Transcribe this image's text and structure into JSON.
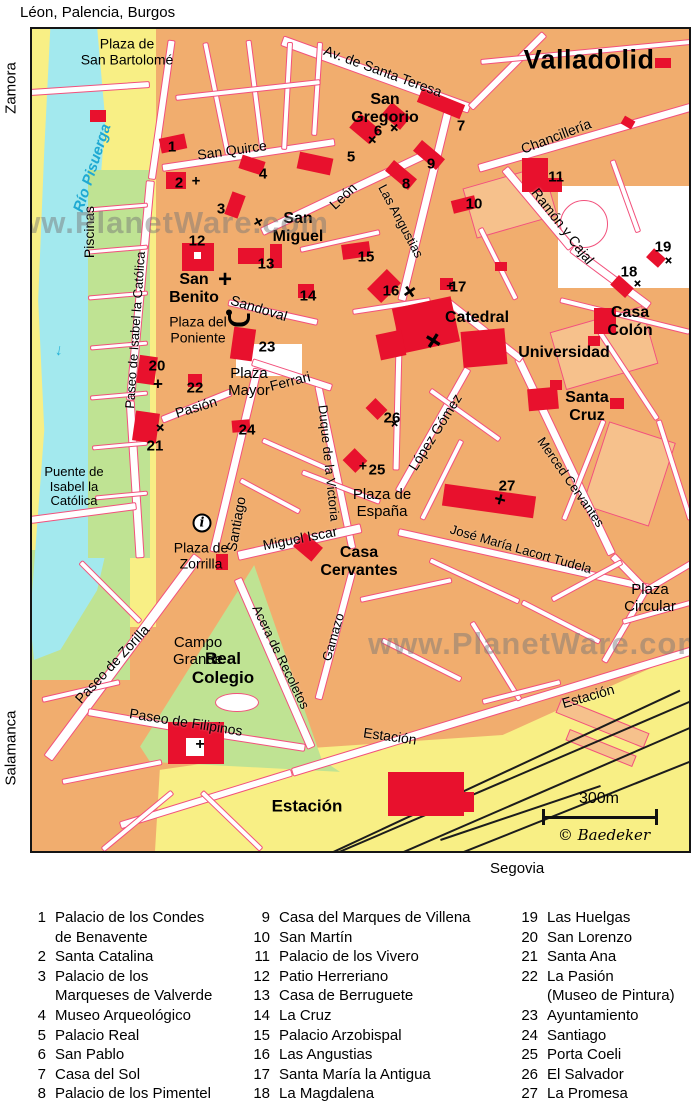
{
  "title": "Valladolid",
  "edges": {
    "top": "Léon, Palencia, Burgos",
    "left_top": "Zamora",
    "left_bottom": "Salamanca",
    "bottom": "Segovia"
  },
  "watermark": {
    "text": "www.PlanetWare.com"
  },
  "scale": {
    "label": "300m",
    "copyright": "© Baedeker"
  },
  "river": {
    "label": "Río Pisuerga",
    "arrow": "↓"
  },
  "info_icon_glyph": "i",
  "colors": {
    "block": "#f1ad6e",
    "block_light": "#f6c18c",
    "road_casing": "#f2517c",
    "building_red": "#e8112d",
    "yellow": "#f8ef85",
    "green": "#bfe393",
    "river_blue": "#a3e9ee",
    "rail_black": "#1c1c1c"
  },
  "street_labels": [
    {
      "text": "Av. de Santa Teresa",
      "x": 383,
      "y": 71,
      "rot": 20,
      "size": 14
    },
    {
      "text": "San Quirce",
      "x": 232,
      "y": 150,
      "rot": -8,
      "size": 14
    },
    {
      "text": "León",
      "x": 343,
      "y": 196,
      "rot": -43,
      "size": 14
    },
    {
      "text": "Las Angustias",
      "x": 401,
      "y": 221,
      "rot": 62,
      "size": 13
    },
    {
      "text": "Chancillería",
      "x": 556,
      "y": 136,
      "rot": -21,
      "size": 14
    },
    {
      "text": "Ramón y Cajal",
      "x": 563,
      "y": 226,
      "rot": 52,
      "size": 14
    },
    {
      "text": "Sandoval",
      "x": 259,
      "y": 308,
      "rot": 17,
      "size": 14
    },
    {
      "text": "Paseo de Isabel la Católica",
      "x": 135,
      "y": 330,
      "rot": -86,
      "size": 13
    },
    {
      "text": "Pasión",
      "x": 196,
      "y": 407,
      "rot": -17,
      "size": 14
    },
    {
      "text": "Ferrari",
      "x": 290,
      "y": 381,
      "rot": -14,
      "size": 14
    },
    {
      "text": "Santiago",
      "x": 236,
      "y": 524,
      "rot": -80,
      "size": 14
    },
    {
      "text": "Duque de la Victoria",
      "x": 329,
      "y": 463,
      "rot": 84,
      "size": 13
    },
    {
      "text": "López Gómez",
      "x": 435,
      "y": 432,
      "rot": -58,
      "size": 14
    },
    {
      "text": "Merced Cervantes",
      "x": 571,
      "y": 482,
      "rot": 55,
      "size": 13
    },
    {
      "text": "José María Lacort Tudela",
      "x": 521,
      "y": 549,
      "rot": 16,
      "size": 13
    },
    {
      "text": "Miguel Iscar",
      "x": 300,
      "y": 538,
      "rot": -11,
      "size": 14
    },
    {
      "text": "Paseo de Zorilla",
      "x": 112,
      "y": 664,
      "rot": -47,
      "size": 14
    },
    {
      "text": "Paseo de Filipinos",
      "x": 186,
      "y": 722,
      "rot": 9,
      "size": 14
    },
    {
      "text": "Acera de Recoletos",
      "x": 281,
      "y": 657,
      "rot": 64,
      "size": 13
    },
    {
      "text": "Gamazo",
      "x": 333,
      "y": 637,
      "rot": -74,
      "size": 13
    },
    {
      "text": "Estación",
      "x": 390,
      "y": 736,
      "rot": 8,
      "size": 14
    },
    {
      "text": "Estación",
      "x": 588,
      "y": 696,
      "rot": -16,
      "size": 14
    },
    {
      "text": "Piscinas",
      "x": 89,
      "y": 232,
      "rot": -90,
      "size": 14
    }
  ],
  "place_labels": [
    {
      "lines": [
        "San",
        "Gregorio"
      ],
      "x": 385,
      "y": 109,
      "size": 16,
      "bold": true
    },
    {
      "lines": [
        "San",
        "Miguel"
      ],
      "x": 298,
      "y": 228,
      "size": 16,
      "bold": true
    },
    {
      "lines": [
        "San",
        "Benito"
      ],
      "x": 194,
      "y": 289,
      "size": 16,
      "bold": true
    },
    {
      "lines": [
        "Catedral"
      ],
      "x": 477,
      "y": 318,
      "size": 16,
      "bold": true
    },
    {
      "lines": [
        "Universidad"
      ],
      "x": 564,
      "y": 353,
      "size": 16,
      "bold": true
    },
    {
      "lines": [
        "Santa",
        "Cruz"
      ],
      "x": 587,
      "y": 407,
      "size": 16,
      "bold": true
    },
    {
      "lines": [
        "Casa",
        "Colón"
      ],
      "x": 630,
      "y": 322,
      "size": 16,
      "bold": true
    },
    {
      "lines": [
        "Casa",
        "Cervantes"
      ],
      "x": 359,
      "y": 562,
      "size": 16,
      "bold": true
    },
    {
      "lines": [
        "Real",
        "Colegio"
      ],
      "x": 223,
      "y": 668,
      "size": 17,
      "bold": true
    },
    {
      "lines": [
        "Estación"
      ],
      "x": 307,
      "y": 806,
      "size": 17,
      "bold": true
    },
    {
      "lines": [
        "Plaza de",
        "San Bartolomé"
      ],
      "x": 127,
      "y": 52,
      "size": 14,
      "bold": false
    },
    {
      "lines": [
        "Plaza del",
        "Poniente"
      ],
      "x": 198,
      "y": 330,
      "size": 14,
      "bold": false
    },
    {
      "lines": [
        "Plaza",
        "Mayor"
      ],
      "x": 249,
      "y": 383,
      "size": 15,
      "bold": false
    },
    {
      "lines": [
        "Plaza de",
        "España"
      ],
      "x": 382,
      "y": 504,
      "size": 15,
      "bold": false
    },
    {
      "lines": [
        "Puente de",
        "Isabel la",
        "Católica"
      ],
      "x": 74,
      "y": 487,
      "size": 13,
      "bold": false
    },
    {
      "lines": [
        "Plaza de",
        "Zorrilla"
      ],
      "x": 201,
      "y": 556,
      "size": 14,
      "bold": false
    },
    {
      "lines": [
        "Campo",
        "Grande"
      ],
      "x": 198,
      "y": 652,
      "size": 15,
      "bold": false
    },
    {
      "lines": [
        "Plaza",
        "Circular"
      ],
      "x": 650,
      "y": 599,
      "size": 15,
      "bold": false
    }
  ],
  "numbers": [
    {
      "n": "1",
      "x": 172,
      "y": 147
    },
    {
      "n": "2",
      "x": 179,
      "y": 183
    },
    {
      "n": "3",
      "x": 221,
      "y": 209
    },
    {
      "n": "4",
      "x": 263,
      "y": 174
    },
    {
      "n": "5",
      "x": 351,
      "y": 157
    },
    {
      "n": "6",
      "x": 378,
      "y": 131
    },
    {
      "n": "7",
      "x": 461,
      "y": 126
    },
    {
      "n": "8",
      "x": 406,
      "y": 184
    },
    {
      "n": "9",
      "x": 431,
      "y": 164
    },
    {
      "n": "10",
      "x": 474,
      "y": 204
    },
    {
      "n": "11",
      "x": 556,
      "y": 177
    },
    {
      "n": "12",
      "x": 197,
      "y": 241
    },
    {
      "n": "13",
      "x": 266,
      "y": 264
    },
    {
      "n": "14",
      "x": 308,
      "y": 296
    },
    {
      "n": "15",
      "x": 366,
      "y": 257
    },
    {
      "n": "16",
      "x": 391,
      "y": 291
    },
    {
      "n": "17",
      "x": 458,
      "y": 287
    },
    {
      "n": "18",
      "x": 629,
      "y": 272
    },
    {
      "n": "19",
      "x": 663,
      "y": 247
    },
    {
      "n": "20",
      "x": 157,
      "y": 366
    },
    {
      "n": "21",
      "x": 155,
      "y": 446
    },
    {
      "n": "22",
      "x": 195,
      "y": 388
    },
    {
      "n": "23",
      "x": 267,
      "y": 347
    },
    {
      "n": "24",
      "x": 247,
      "y": 430
    },
    {
      "n": "25",
      "x": 377,
      "y": 470
    },
    {
      "n": "26",
      "x": 392,
      "y": 418
    },
    {
      "n": "27",
      "x": 507,
      "y": 486
    }
  ],
  "legend": {
    "columns": [
      [
        {
          "n": "1",
          "lines": [
            "Palacio de los Condes",
            "de Benavente"
          ]
        },
        {
          "n": "2",
          "lines": [
            "Santa Catalina"
          ]
        },
        {
          "n": "3",
          "lines": [
            "Palacio de los",
            "Marqueses de Valverde"
          ]
        },
        {
          "n": "4",
          "lines": [
            "Museo Arqueológico"
          ]
        },
        {
          "n": "5",
          "lines": [
            "Palacio Real"
          ]
        },
        {
          "n": "6",
          "lines": [
            "San Pablo"
          ]
        },
        {
          "n": "7",
          "lines": [
            "Casa del Sol"
          ]
        },
        {
          "n": "8",
          "lines": [
            "Palacio de los Pimentel"
          ]
        }
      ],
      [
        {
          "n": "9",
          "lines": [
            "Casa del Marques de Villena"
          ]
        },
        {
          "n": "10",
          "lines": [
            "San Martín"
          ]
        },
        {
          "n": "11",
          "lines": [
            "Palacio de los Vivero"
          ]
        },
        {
          "n": "12",
          "lines": [
            "Patio Herreriano"
          ]
        },
        {
          "n": "13",
          "lines": [
            "Casa de Berruguete"
          ]
        },
        {
          "n": "14",
          "lines": [
            "La Cruz"
          ]
        },
        {
          "n": "15",
          "lines": [
            "Palacio Arzobispal"
          ]
        },
        {
          "n": "16",
          "lines": [
            "Las Angustias"
          ]
        },
        {
          "n": "17",
          "lines": [
            "Santa María la Antigua"
          ]
        },
        {
          "n": "18",
          "lines": [
            "La Magdalena"
          ]
        }
      ],
      [
        {
          "n": "19",
          "lines": [
            "Las Huelgas"
          ]
        },
        {
          "n": "20",
          "lines": [
            "San Lorenzo"
          ]
        },
        {
          "n": "21",
          "lines": [
            "Santa Ana"
          ]
        },
        {
          "n": "22",
          "lines": [
            "La Pasión",
            "(Museo de Pintura)"
          ]
        },
        {
          "n": "23",
          "lines": [
            "Ayuntamiento"
          ]
        },
        {
          "n": "24",
          "lines": [
            "Santiago"
          ]
        },
        {
          "n": "25",
          "lines": [
            "Porta Coeli"
          ]
        },
        {
          "n": "26",
          "lines": [
            "El Salvador"
          ]
        },
        {
          "n": "27",
          "lines": [
            "La Promesa"
          ]
        }
      ]
    ]
  }
}
